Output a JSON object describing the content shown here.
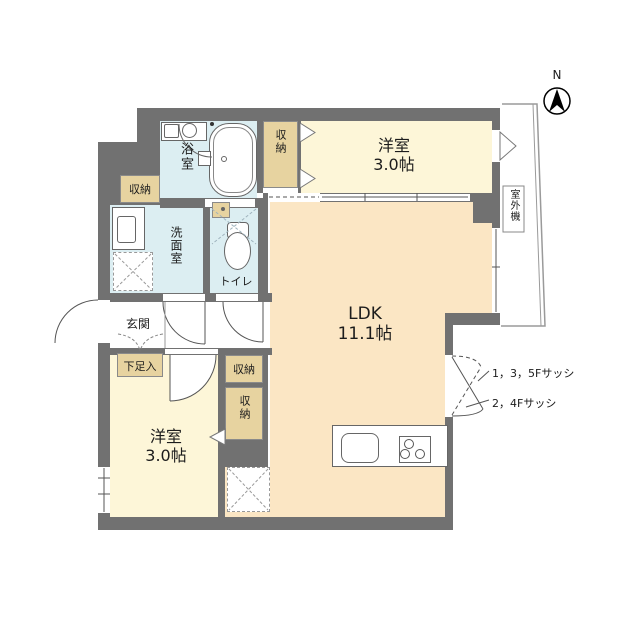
{
  "plan_title": "floor-plan",
  "labels": {
    "bathroom": "浴室",
    "washroom": "洗面室",
    "toilet": "トイレ",
    "entrance": "玄関",
    "shoe_cabinet": "下足入",
    "storage_top_left": "収納",
    "storage_bedroom_top": "収納",
    "storage_hall": "収納",
    "storage_bedroom_bottom": "収納",
    "outdoor_unit": "室外機",
    "compass_north": "N",
    "bedroom_top": {
      "name": "洋室",
      "size": "3.0帖"
    },
    "bedroom_bottom": {
      "name": "洋室",
      "size": "3.0帖"
    },
    "ldk": {
      "name": "LDK",
      "size": "11.1帖"
    },
    "sash_135": "1，3，5Fサッシ",
    "sash_24": "2，4Fサッシ"
  },
  "colors": {
    "wall": "#717171",
    "ldk_floor": "#fbe6c4",
    "bedroom_floor": "#fdf6d8",
    "wet_room_floor": "#dceef2",
    "closet": "#e7d3a0",
    "outline": "#555555"
  }
}
